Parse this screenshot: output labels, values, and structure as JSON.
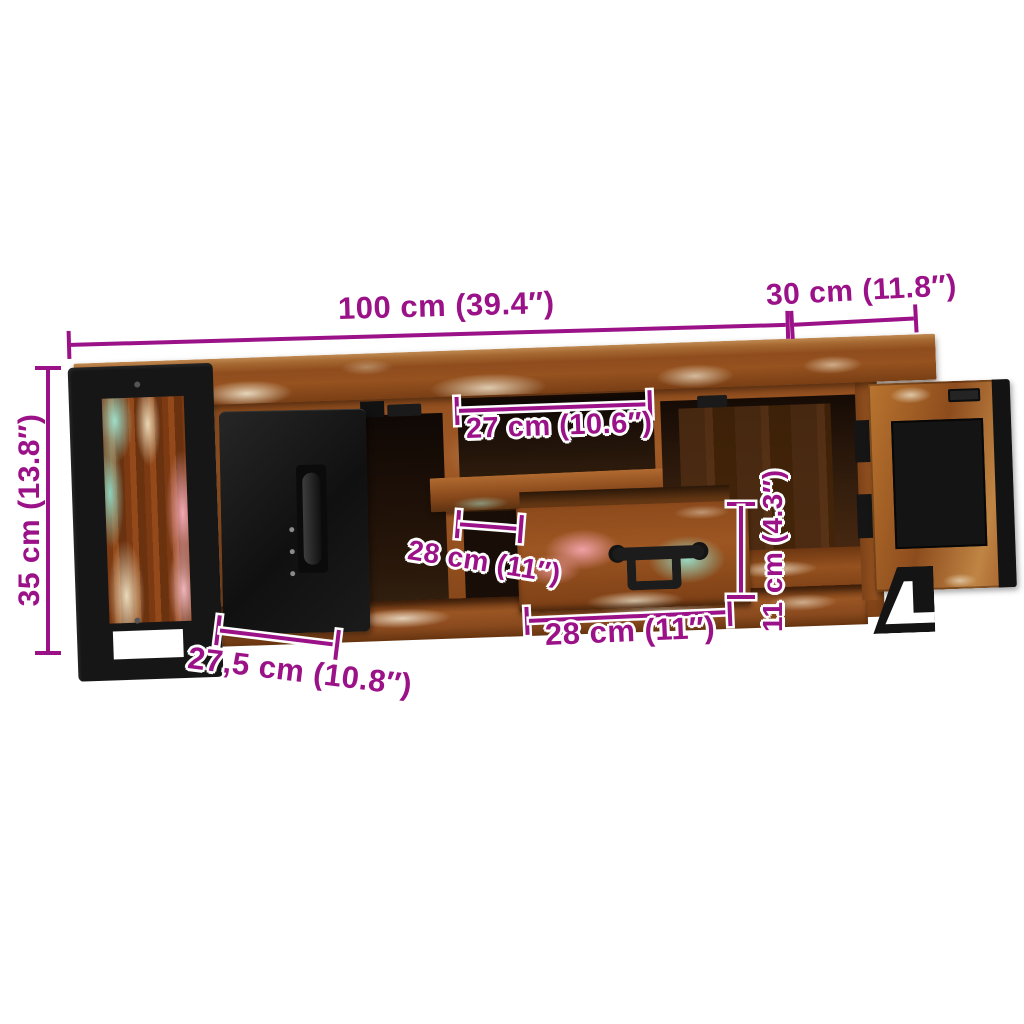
{
  "page": {
    "background": "#ffffff",
    "description": "Product dimension diagram of a TV stand in solid reclaimed wood with black metal side frames, one black open door, one wooden open door and a pulled-out drawer"
  },
  "colors": {
    "dimension": "#9b1188",
    "label_outline": "#ffffff",
    "metal_black": "#161616",
    "wood_base": "#9a5523"
  },
  "dimensions": {
    "overall_width": {
      "label": "100 cm (39.4″)"
    },
    "overall_depth": {
      "label": "30 cm (11.8″)"
    },
    "overall_height": {
      "label": "35 cm (13.8″)"
    },
    "compartment_width": {
      "label": "27 cm (10.6″)"
    },
    "compartment_depth": {
      "label": "28 cm (11″)"
    },
    "drawer_width": {
      "label": "28 cm (11″)"
    },
    "drawer_height": {
      "label": "11 cm (4.3″)"
    },
    "door_width": {
      "label": "27,5 cm (10.8″)"
    }
  }
}
